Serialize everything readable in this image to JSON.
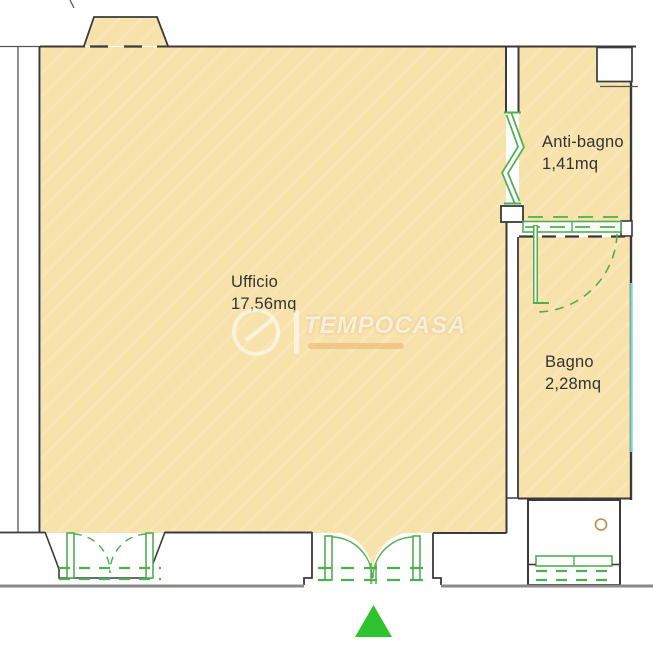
{
  "plan": {
    "rooms": [
      {
        "name": "Ufficio",
        "area": "17,56mq"
      },
      {
        "name": "Anti-bagno",
        "area": "1,41mq"
      },
      {
        "name": "Bagno",
        "area": "2,28mq"
      }
    ],
    "watermark": {
      "brand": "TEMPOCASA"
    },
    "colors": {
      "floor": "#F8E2AC",
      "wall": "#3a3a3a",
      "fixture_green": "#4fae4f",
      "entrance_marker": "#2ec22e",
      "water_teal": "#7fd7d7",
      "ground": "#8a8a8a"
    }
  }
}
